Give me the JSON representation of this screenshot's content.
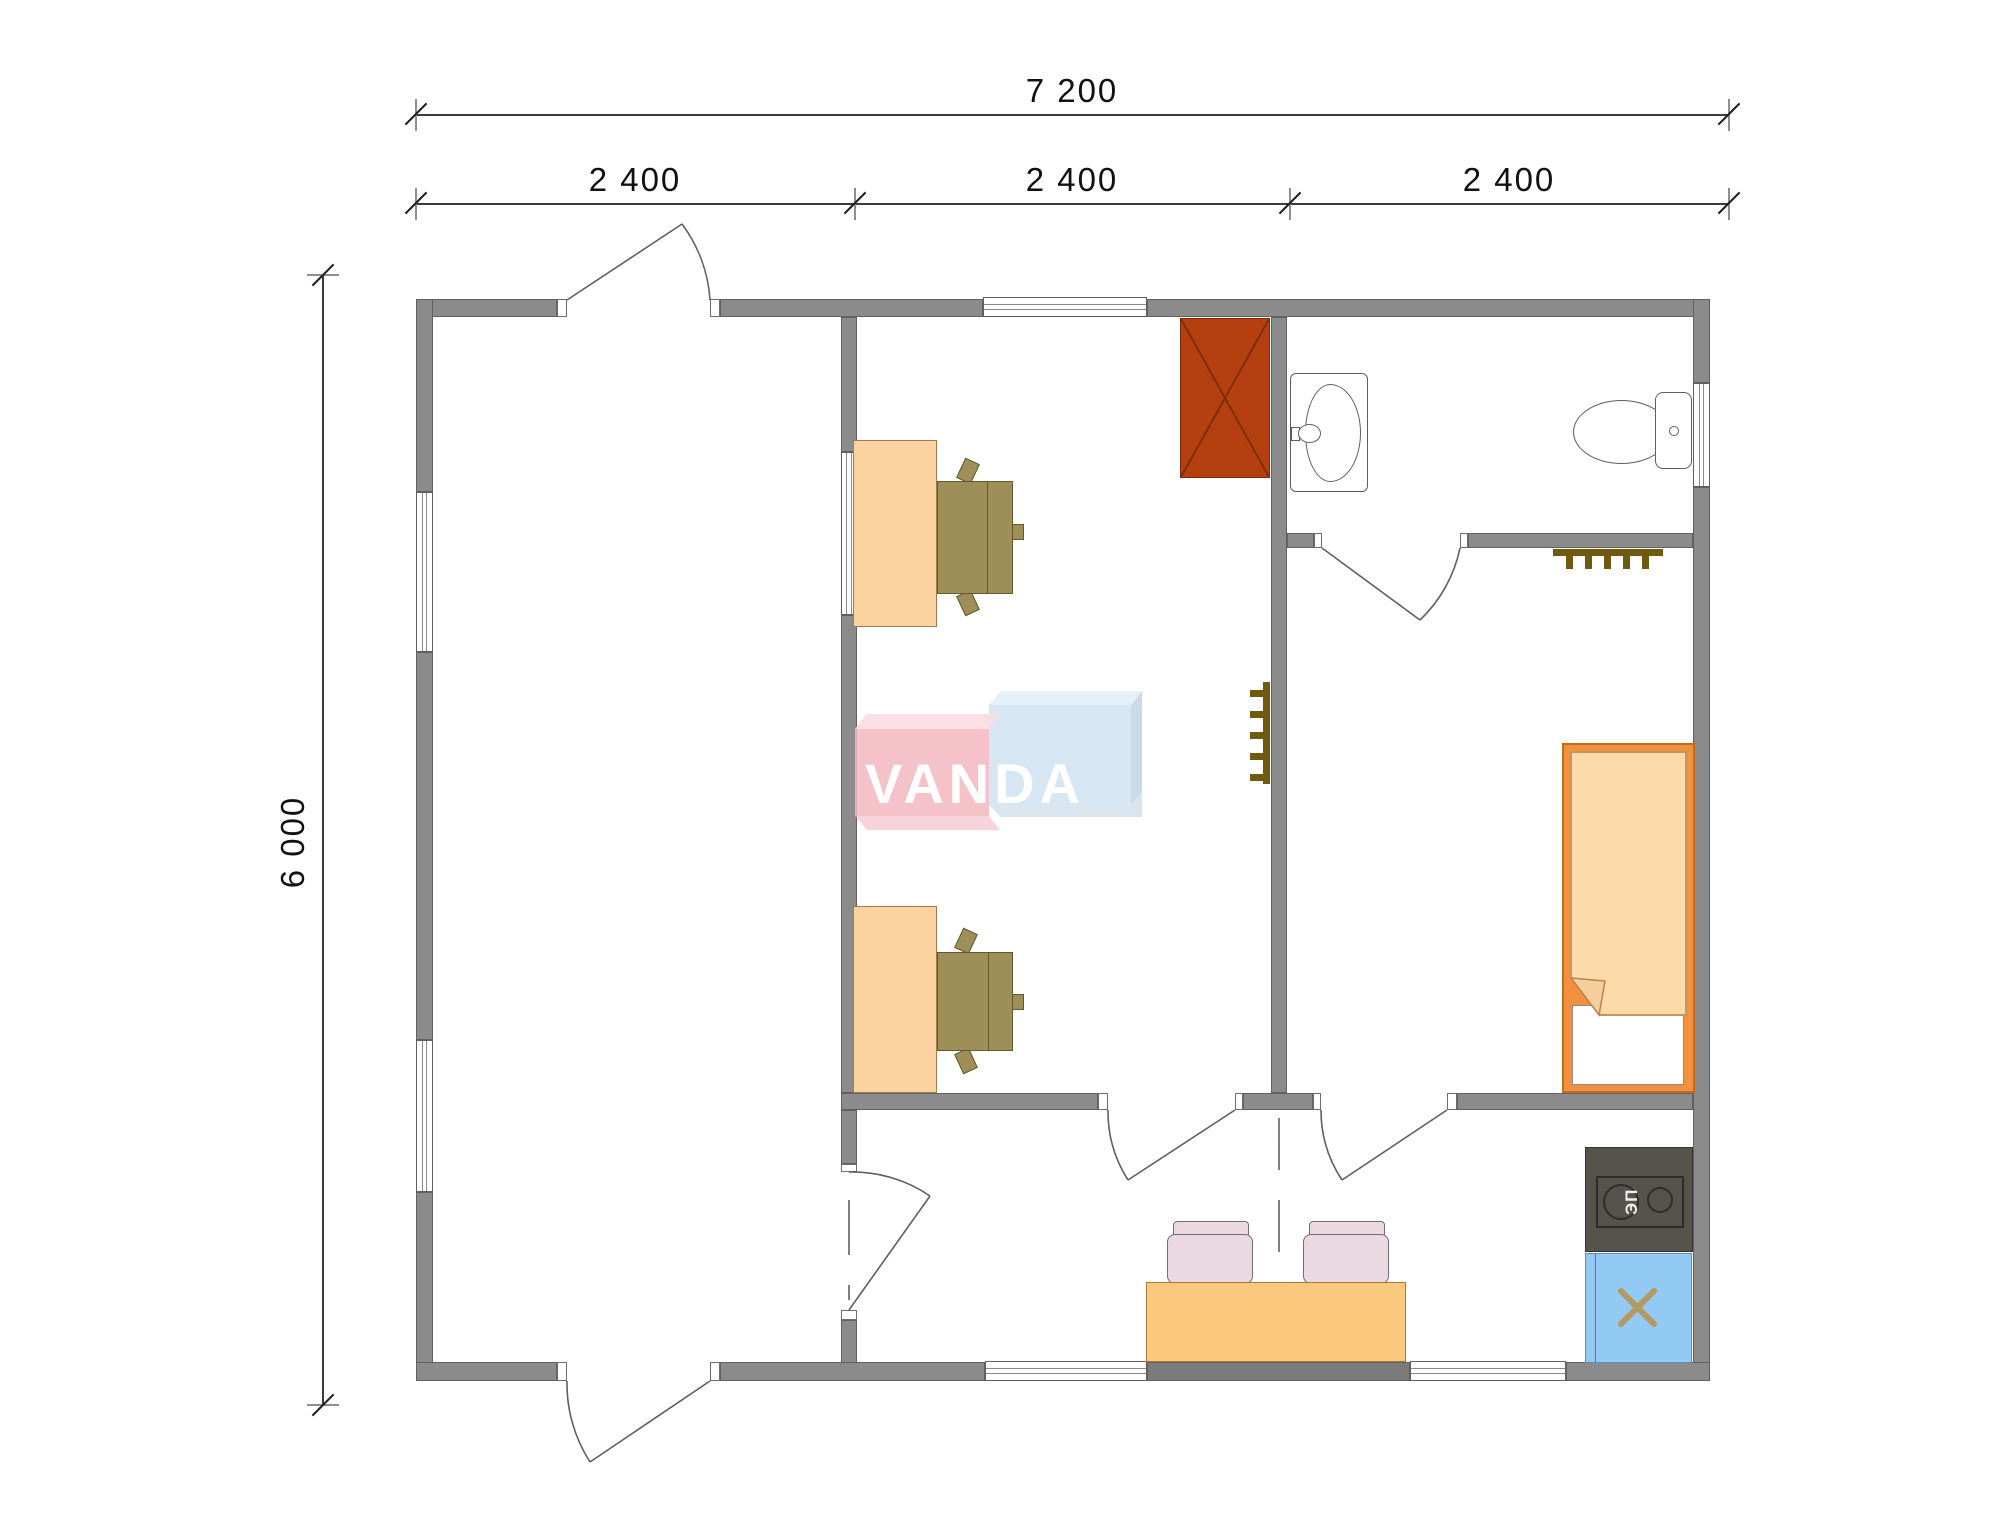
{
  "plan": {
    "title": "modular-house-floor-plan",
    "dimensions": {
      "total_width_label": "7 200",
      "segment_labels": [
        "2 400",
        "2 400",
        "2 400"
      ],
      "total_height_label": "6 000"
    },
    "logo": {
      "text": "VANDA",
      "red_color": "#f3b7c1",
      "blue_color": "#cfe2f1"
    },
    "kitchen": {
      "stove_label": "ЭП"
    },
    "colors": {
      "wall": "#8b8b8b",
      "desk_wood": "#fcd2a0",
      "table_wood": "#fbc97e",
      "office_chair": "#9d8f57",
      "dining_chair": "#ead9e1",
      "bed_frame": "#f2903e",
      "mattress": "#fcdaaa",
      "wardrobe": "#b5400f",
      "stove": "#56534c",
      "shower": "#93caf4",
      "radiator": "#6f5a10"
    },
    "fixtures": [
      "wardrobe",
      "desk",
      "office-chair",
      "interior-window",
      "sink",
      "toilet",
      "bed",
      "radiator",
      "dining-table",
      "dining-chair",
      "stove",
      "shower-cabin",
      "door",
      "window"
    ]
  }
}
